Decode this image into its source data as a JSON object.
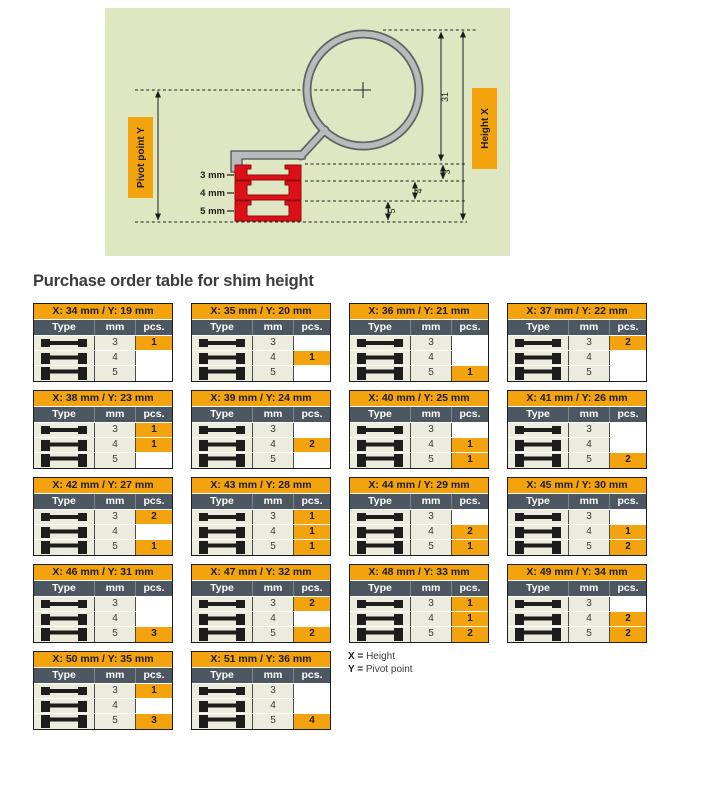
{
  "section_title": "Purchase order table for shim height",
  "diagram": {
    "pivot_label": {
      "text": "Pivot point ",
      "suffix": "Y"
    },
    "height_label": {
      "text": "Height ",
      "suffix": "X"
    },
    "dim_loop": "31",
    "dims": {
      "d3": "3",
      "d4": "4",
      "d5": "5"
    },
    "shim_labels": {
      "s3": "3 mm",
      "s4": "4 mm",
      "s5": "5 mm"
    },
    "colors": {
      "panel_bg": "#dfe6c2",
      "accent_orange": "#f2a30d",
      "shim_red": "#df0f17",
      "clamp_gray": "#b9babc",
      "header_slate": "#4d5761",
      "cell_green": "#ebecde"
    }
  },
  "table_template": {
    "columns": [
      "Type",
      "mm",
      "pcs."
    ],
    "rows_mm": [
      "3",
      "4",
      "5"
    ]
  },
  "tables": [
    {
      "title": "X: 34 mm / Y: 19 mm",
      "pcs": [
        "1",
        "",
        ""
      ]
    },
    {
      "title": "X: 35 mm / Y: 20 mm",
      "pcs": [
        "",
        "1",
        ""
      ]
    },
    {
      "title": "X: 36 mm / Y: 21 mm",
      "pcs": [
        "",
        "",
        "1"
      ]
    },
    {
      "title": "X: 37 mm / Y: 22 mm",
      "pcs": [
        "2",
        "",
        ""
      ]
    },
    {
      "title": "X: 38 mm / Y: 23 mm",
      "pcs": [
        "1",
        "1",
        ""
      ]
    },
    {
      "title": "X: 39 mm / Y: 24 mm",
      "pcs": [
        "",
        "2",
        ""
      ]
    },
    {
      "title": "X: 40 mm / Y: 25 mm",
      "pcs": [
        "",
        "1",
        "1"
      ]
    },
    {
      "title": "X: 41 mm / Y: 26 mm",
      "pcs": [
        "",
        "",
        "2"
      ]
    },
    {
      "title": "X: 42 mm / Y: 27 mm",
      "pcs": [
        "2",
        "",
        "1"
      ]
    },
    {
      "title": "X: 43 mm / Y: 28 mm",
      "pcs": [
        "1",
        "1",
        "1"
      ]
    },
    {
      "title": "X: 44 mm / Y: 29 mm",
      "pcs": [
        "",
        "2",
        "1"
      ]
    },
    {
      "title": "X: 45 mm / Y: 30 mm",
      "pcs": [
        "",
        "1",
        "2"
      ]
    },
    {
      "title": "X: 46 mm / Y: 31 mm",
      "pcs": [
        "",
        "",
        "3"
      ]
    },
    {
      "title": "X: 47 mm / Y: 32 mm",
      "pcs": [
        "2",
        "",
        "2"
      ]
    },
    {
      "title": "X: 48 mm / Y: 33 mm",
      "pcs": [
        "1",
        "1",
        "2"
      ]
    },
    {
      "title": "X: 49 mm / Y: 34 mm",
      "pcs": [
        "",
        "2",
        "2"
      ]
    },
    {
      "title": "X: 50 mm / Y: 35 mm",
      "pcs": [
        "1",
        "",
        "3"
      ]
    },
    {
      "title": "X: 51 mm / Y: 36 mm",
      "pcs": [
        "",
        "",
        "4"
      ]
    }
  ],
  "legend": [
    {
      "key": "X =",
      "text": "Height"
    },
    {
      "key": "Y =",
      "text": "Pivot point"
    }
  ]
}
